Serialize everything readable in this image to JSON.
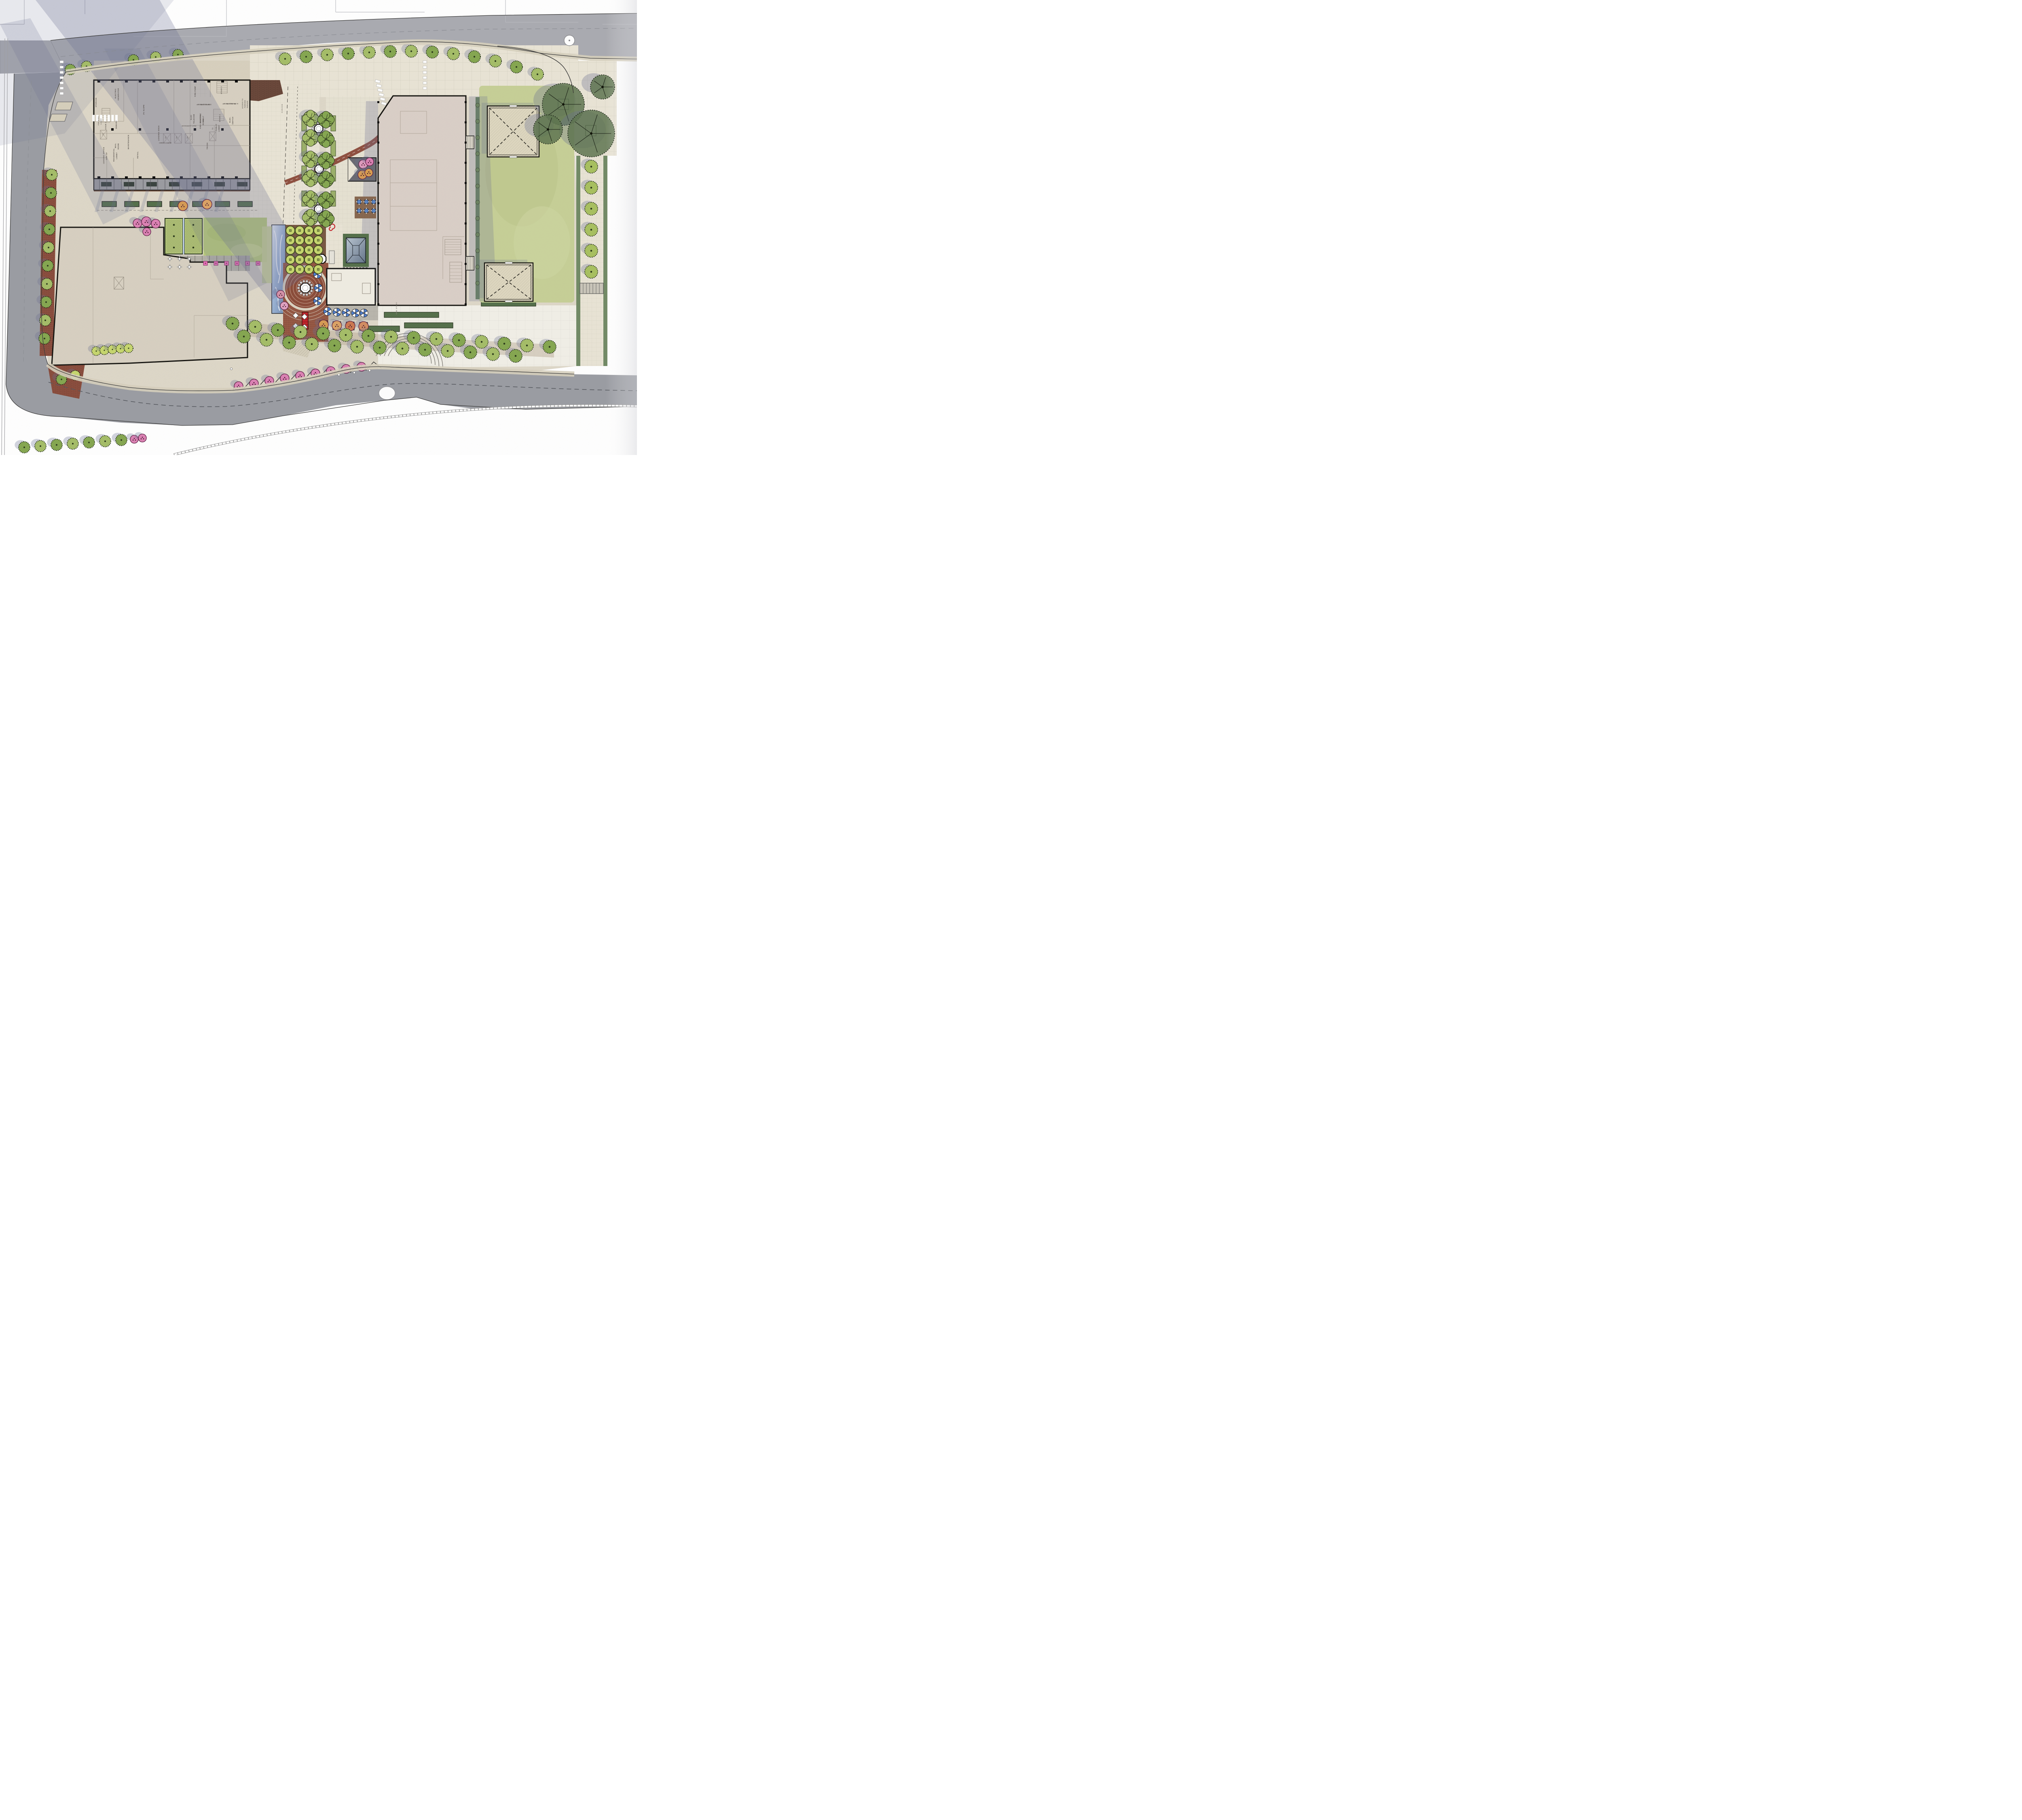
{
  "drawing": {
    "kind": "illustrative landscape site plan",
    "orientation": "plan view"
  },
  "palette": {
    "page_bg": "#ffffff",
    "road": "#aaabb1",
    "road_dark": "#9b9da3",
    "sidewalk": "#d6cfbc",
    "site_ground": "#ddd7c8",
    "paving_light": "#e9e4d5",
    "paving_white": "#f1efe7",
    "building_fill": "#d7d0c1",
    "building_east_fill": "#dacfc7",
    "building_outline": "#161511",
    "interior_line": "#a1988a",
    "lawn": "#c6cf97",
    "lawn_bright": "#b8ca7c",
    "tree_green": "#85a751",
    "tree_green_light": "#a5bd68",
    "tree_lime": "#c6d66e",
    "tree_dark": "#5e7450",
    "tree_pink": "#ee8cc3",
    "tree_orange": "#e8a85c",
    "tree_rust": "#dd8258",
    "hedge": "#5d7a52",
    "water_light": "#dce6f2",
    "water_deep": "#7f9cc4",
    "brick": "#8f5040",
    "brick_ring": "#c4a08c",
    "umbrella_blue": "#4f7fd0",
    "feature_red": "#c4242b",
    "shadow": "#6b7092",
    "label_ink": "#4a4440",
    "curb": "#3c3c3c",
    "table_blue": "#5b84c4",
    "table_pink": "#e870b8"
  },
  "labels": [
    "STORAGE",
    "ELECTRIC",
    "GENERATOR",
    "DEMARC",
    "MAIL",
    "ROOM",
    "MAINTENANCE",
    "LOADING DOCK",
    "2% SLOPE",
    "ELECTRIC",
    "VAULT",
    "ELEC.",
    "SWITCH",
    "TRASH",
    "STAIR 1",
    "FSE ELEV.",
    "LOBBY",
    "ELEV. LOBBY",
    "T1",
    "T3",
    "T4",
    "T5",
    "FIRE PUMP",
    "STAIR 3",
    "SPEED RAMP",
    "15% SLOPE",
    "TRANS. RAMP",
    "6.5% SLOPE",
    "ACCESS TO",
    "PARKING",
    "GARAGE",
    "ELEC",
    "TELECOM",
    "FIRE CONTROL",
    "ROOM",
    "EXIT CORRIDOR",
    "STAIR 2",
    "PUBLIC",
    "LOBBY",
    "T2",
    "LEASING OFFICE",
    "1490 SF",
    "RESIDENTIAL",
    "LOBBY",
    "RETAIL",
    "GARAGE",
    "ONE STORY"
  ]
}
